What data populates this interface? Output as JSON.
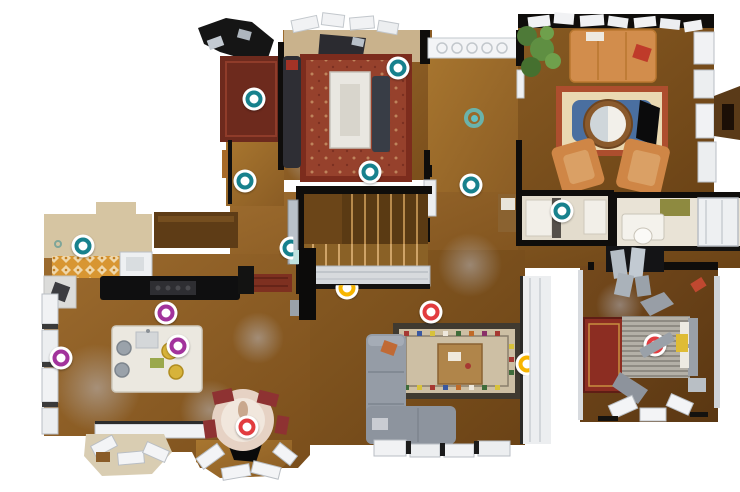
{
  "canvas": {
    "width": 740,
    "height": 492,
    "background": "#ffffff"
  },
  "marker_colors": {
    "teal": "#17818d",
    "red": "#e23c3f",
    "yellow": "#f7b500",
    "magenta": "#a2339c",
    "active": "#5fc6cc"
  },
  "scan_markers": [
    {
      "id": "scan-01",
      "x": 254,
      "y": 99,
      "color": "teal",
      "variant": "standard",
      "occlusion": "none"
    },
    {
      "id": "scan-02",
      "x": 245,
      "y": 181,
      "color": "teal",
      "variant": "standard",
      "occlusion": "none"
    },
    {
      "id": "scan-03",
      "x": 398,
      "y": 68,
      "color": "teal",
      "variant": "standard",
      "occlusion": "none"
    },
    {
      "id": "current",
      "x": 474,
      "y": 118,
      "color": "active",
      "variant": "active",
      "occlusion": "none"
    },
    {
      "id": "scan-04",
      "x": 370,
      "y": 172,
      "color": "teal",
      "variant": "standard",
      "occlusion": "none"
    },
    {
      "id": "scan-05",
      "x": 471,
      "y": 185,
      "color": "teal",
      "variant": "standard",
      "occlusion": "none"
    },
    {
      "id": "scan-06",
      "x": 562,
      "y": 211,
      "color": "teal",
      "variant": "standard",
      "occlusion": "none"
    },
    {
      "id": "scan-07",
      "x": 83,
      "y": 246,
      "color": "teal",
      "variant": "standard",
      "occlusion": "none"
    },
    {
      "id": "scan-08",
      "x": 58,
      "y": 244,
      "color": "teal",
      "variant": "faint",
      "occlusion": "none"
    },
    {
      "id": "scan-09",
      "x": 291,
      "y": 248,
      "color": "teal",
      "variant": "standard",
      "occlusion": "right"
    },
    {
      "id": "scan-10",
      "x": 347,
      "y": 288,
      "color": "yellow",
      "variant": "standard",
      "occlusion": "top"
    },
    {
      "id": "scan-11",
      "x": 166,
      "y": 313,
      "color": "magenta",
      "variant": "standard",
      "occlusion": "none"
    },
    {
      "id": "scan-12",
      "x": 178,
      "y": 346,
      "color": "magenta",
      "variant": "standard",
      "occlusion": "none"
    },
    {
      "id": "scan-13",
      "x": 61,
      "y": 358,
      "color": "magenta",
      "variant": "standard",
      "occlusion": "none"
    },
    {
      "id": "scan-14",
      "x": 247,
      "y": 427,
      "color": "red",
      "variant": "standard",
      "occlusion": "none"
    },
    {
      "id": "scan-15",
      "x": 431,
      "y": 312,
      "color": "red",
      "variant": "standard",
      "occlusion": "none"
    },
    {
      "id": "scan-16",
      "x": 527,
      "y": 364,
      "color": "yellow",
      "variant": "standard",
      "occlusion": "right"
    },
    {
      "id": "scan-17",
      "x": 655,
      "y": 345,
      "color": "red",
      "variant": "standard",
      "occlusion": "diagonal"
    }
  ],
  "occluders": [
    {
      "x": 657,
      "y": 345,
      "w": 36,
      "h": 10,
      "rotate": -30,
      "color": "#9aa1a9"
    }
  ]
}
